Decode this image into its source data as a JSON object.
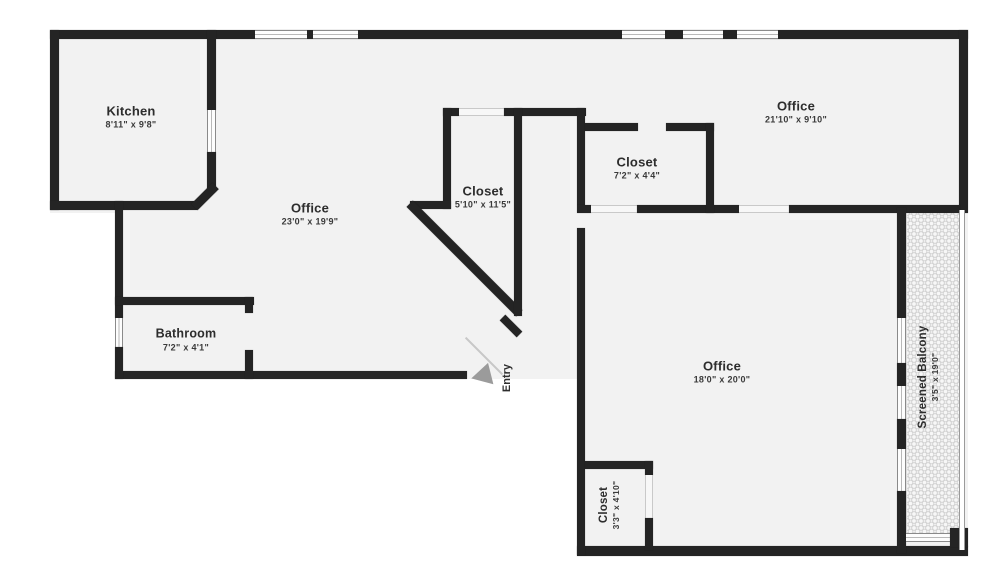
{
  "rooms": {
    "kitchen": {
      "name": "Kitchen",
      "dims": "8'11\" x 9'8\""
    },
    "office_main": {
      "name": "Office",
      "dims": "23'0\" x 19'9\""
    },
    "closet_main": {
      "name": "Closet",
      "dims": "5'10\" x 11'5\""
    },
    "closet_upper": {
      "name": "Closet",
      "dims": "7'2\" x 4'4\""
    },
    "office_upper": {
      "name": "Office",
      "dims": "21'10\" x 9'10\""
    },
    "office_lower": {
      "name": "Office",
      "dims": "18'0\" x 20'0\""
    },
    "bathroom": {
      "name": "Bathroom",
      "dims": "7'2\" x 4'1\""
    },
    "closet_lower": {
      "name": "Closet",
      "dims": "3'3\" x 4'10\""
    },
    "balcony": {
      "name": "Screened Balcony",
      "dims": "3'5\" x 19'0\""
    }
  },
  "entry": {
    "label": "Entry"
  },
  "colors": {
    "wall": "#242424",
    "floor": "#f2f2f2",
    "entry_arrow": "#9b9b9b"
  }
}
